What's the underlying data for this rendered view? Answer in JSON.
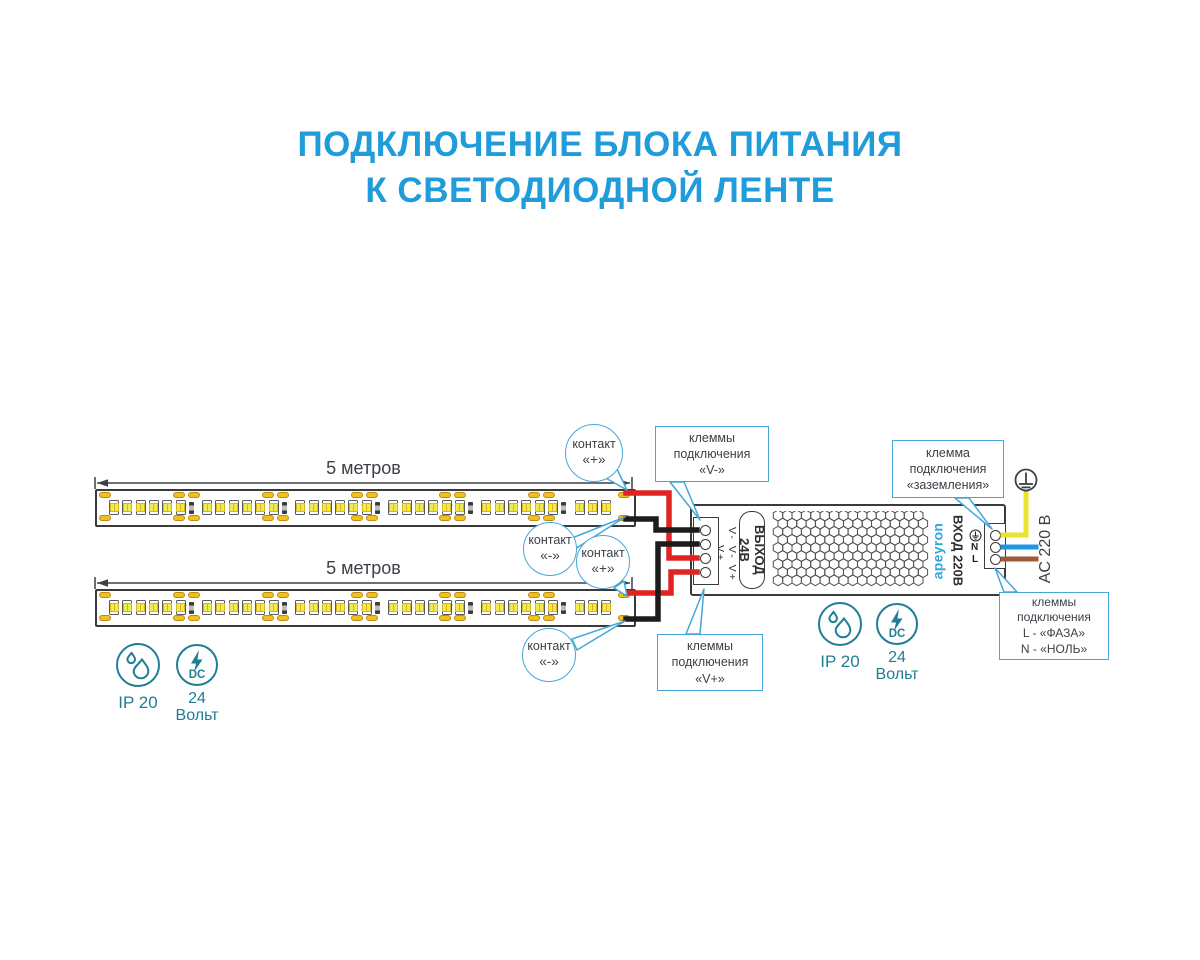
{
  "title": {
    "line1": "ПОДКЛЮЧЕНИЕ БЛОКА ПИТАНИЯ",
    "line2": "К СВЕТОДИОДНОЙ ЛЕНТЕ"
  },
  "strips": [
    {
      "length_label": "5 метров"
    },
    {
      "length_label": "5 метров"
    }
  ],
  "callouts": {
    "contact_plus_top": {
      "line1": "контакт",
      "line2": "«+»"
    },
    "contact_minus_top": {
      "line1": "контакт",
      "line2": "«-»"
    },
    "contact_plus_bottom": {
      "line1": "контакт",
      "line2": "«+»"
    },
    "contact_minus_bottom": {
      "line1": "контакт",
      "line2": "«-»"
    },
    "v_minus": {
      "line1": "клеммы",
      "line2": "подключения",
      "line3": "«V-»"
    },
    "v_plus": {
      "line1": "клеммы",
      "line2": "подключения",
      "line3": "«V+»"
    },
    "ground": {
      "line1": "клемма",
      "line2": "подключения",
      "line3": "«заземления»"
    },
    "mains": {
      "line1": "клеммы",
      "line2": "подключения",
      "line3": "L - «ФАЗА»",
      "line4": "N - «НОЛЬ»"
    }
  },
  "psu": {
    "brand": "apeyron",
    "output_label": "ВЫХОД 24В",
    "input_label": "ВХОД 220В",
    "dc_terminal_labels": "V- V- V+ V+",
    "ac_terminal_n": "N",
    "ac_terminal_l": "L"
  },
  "ac_supply_label": "AC 220 В",
  "badges": {
    "ip_label": "IP 20",
    "dc_label": "DC",
    "volt_line1": "24",
    "volt_line2": "Вольт"
  },
  "icons": {
    "ip_badge": "water-drops-icon",
    "dc_badge": "lightning-bolt-icon",
    "earth": "earth-ground-icon",
    "cut_mark": "✂"
  },
  "colors": {
    "title_blue": "#1f9cd9",
    "callout_blue": "#45a8d8",
    "wire_red": "#e02423",
    "wire_black": "#1c1c1c",
    "wire_yellow": "#e8e42e",
    "wire_blue": "#2196e0",
    "wire_brown": "#a05a35",
    "pad_yellow": "#f0c01f",
    "icon_teal": "#1f7e95",
    "brand_blue": "#2aa9e0"
  }
}
